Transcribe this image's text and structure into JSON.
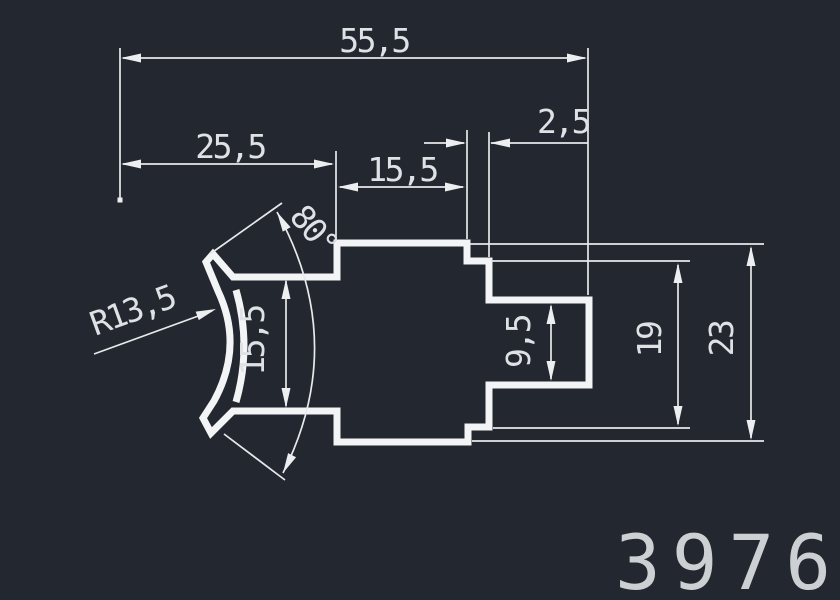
{
  "drawing": {
    "part_number": "3976",
    "colors": {
      "background": "#232830",
      "profile_line": "#f2f4f6",
      "dimension_line": "#e7e9eb",
      "dimension_text": "#dfe2e4",
      "part_number_text": "#ccd0d3"
    },
    "labels": {
      "total_width": "55,5",
      "left_offset": "25,5",
      "body_width": "15,5",
      "lip_width": "2,5",
      "jaw_opening": "15,5",
      "slot_height": "9,5",
      "inner_height": "19",
      "total_height": "23",
      "jaw_radius": "R13,5",
      "jaw_angle": "80°"
    }
  }
}
